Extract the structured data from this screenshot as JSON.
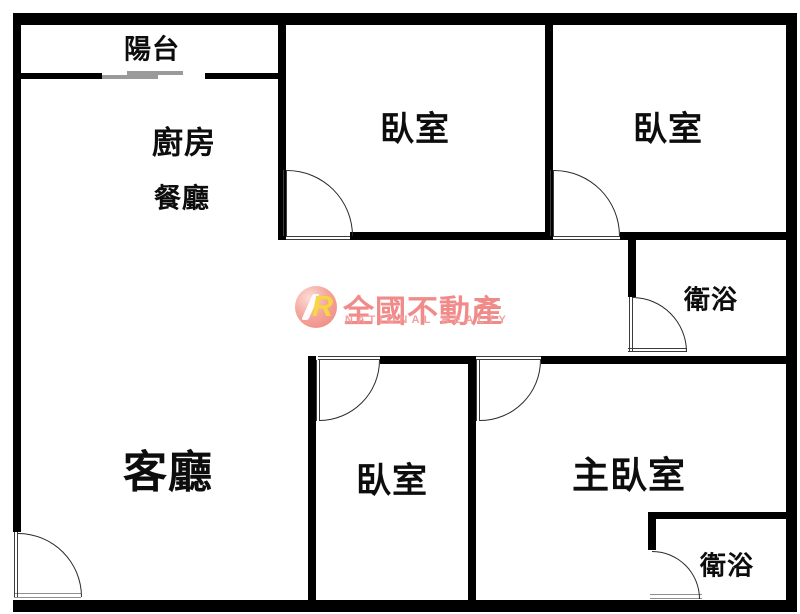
{
  "page": {
    "background": "#ffffff",
    "width": 800,
    "height": 614
  },
  "rooms": [
    {
      "id": "balcony",
      "label": "陽台",
      "x": 152,
      "y": 47,
      "size": 27
    },
    {
      "id": "kitchen",
      "label": "廚房",
      "x": 184,
      "y": 140,
      "size": 31
    },
    {
      "id": "dining",
      "label": "餐廳",
      "x": 182,
      "y": 196,
      "size": 27
    },
    {
      "id": "bedroom-top-middle",
      "label": "臥室",
      "x": 415,
      "y": 126,
      "size": 34
    },
    {
      "id": "bedroom-top-right",
      "label": "臥室",
      "x": 668,
      "y": 126,
      "size": 34
    },
    {
      "id": "bathroom-upper",
      "label": "衛浴",
      "x": 711,
      "y": 298,
      "size": 26
    },
    {
      "id": "living-room",
      "label": "客廳",
      "x": 168,
      "y": 468,
      "size": 44
    },
    {
      "id": "bedroom-bottom",
      "label": "臥室",
      "x": 392,
      "y": 478,
      "size": 35
    },
    {
      "id": "master-bedroom",
      "label": "主臥室",
      "x": 629,
      "y": 472,
      "size": 37
    },
    {
      "id": "bathroom-lower",
      "label": "衛浴",
      "x": 727,
      "y": 564,
      "size": 26
    }
  ],
  "watermark": {
    "brand_cn": "全國不動產",
    "brand_en": "NATIONAL REALTY",
    "logo_monogram": "R",
    "colors": {
      "brand_pink": "#f08b8a",
      "brand_pink_light": "#f1a09d",
      "logo_circle": "#ee837c",
      "logo_r_yellow": "#f8d643"
    }
  },
  "colors": {
    "wall": "#000000",
    "door_line": "#3c3c3c",
    "slider_gray": "#9a9a9a",
    "label_text": "#0d0d0d"
  }
}
